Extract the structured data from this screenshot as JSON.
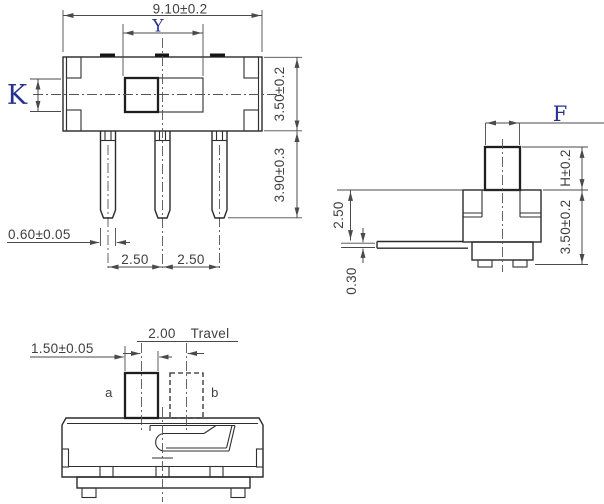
{
  "front_view": {
    "dim_width": "9.10±0.2",
    "dim_slot_width": "Y",
    "dim_knob_height": "K",
    "dim_body_height": "3.50±0.2",
    "dim_terminal_length": "3.90±0.3",
    "dim_terminal_width": "0.60±0.05",
    "dim_pitch_left": "2.50",
    "dim_pitch_right": "2.50"
  },
  "side_view": {
    "dim_knob_width": "F",
    "dim_knob_height": "H±0.2",
    "dim_body_height": "3.50±0.2",
    "dim_terminal_drop": "2.50",
    "dim_terminal_thickness": "0.30"
  },
  "bottom_view": {
    "dim_travel": "2.00",
    "travel_label": "Travel",
    "dim_knob_width": "1.50±0.05",
    "position_a": "a",
    "position_b": "b"
  },
  "colors": {
    "line": "#2b2b2b",
    "dim_text": "#3f3f3f",
    "letter_text": "#26318f",
    "background": "#ffffff"
  }
}
